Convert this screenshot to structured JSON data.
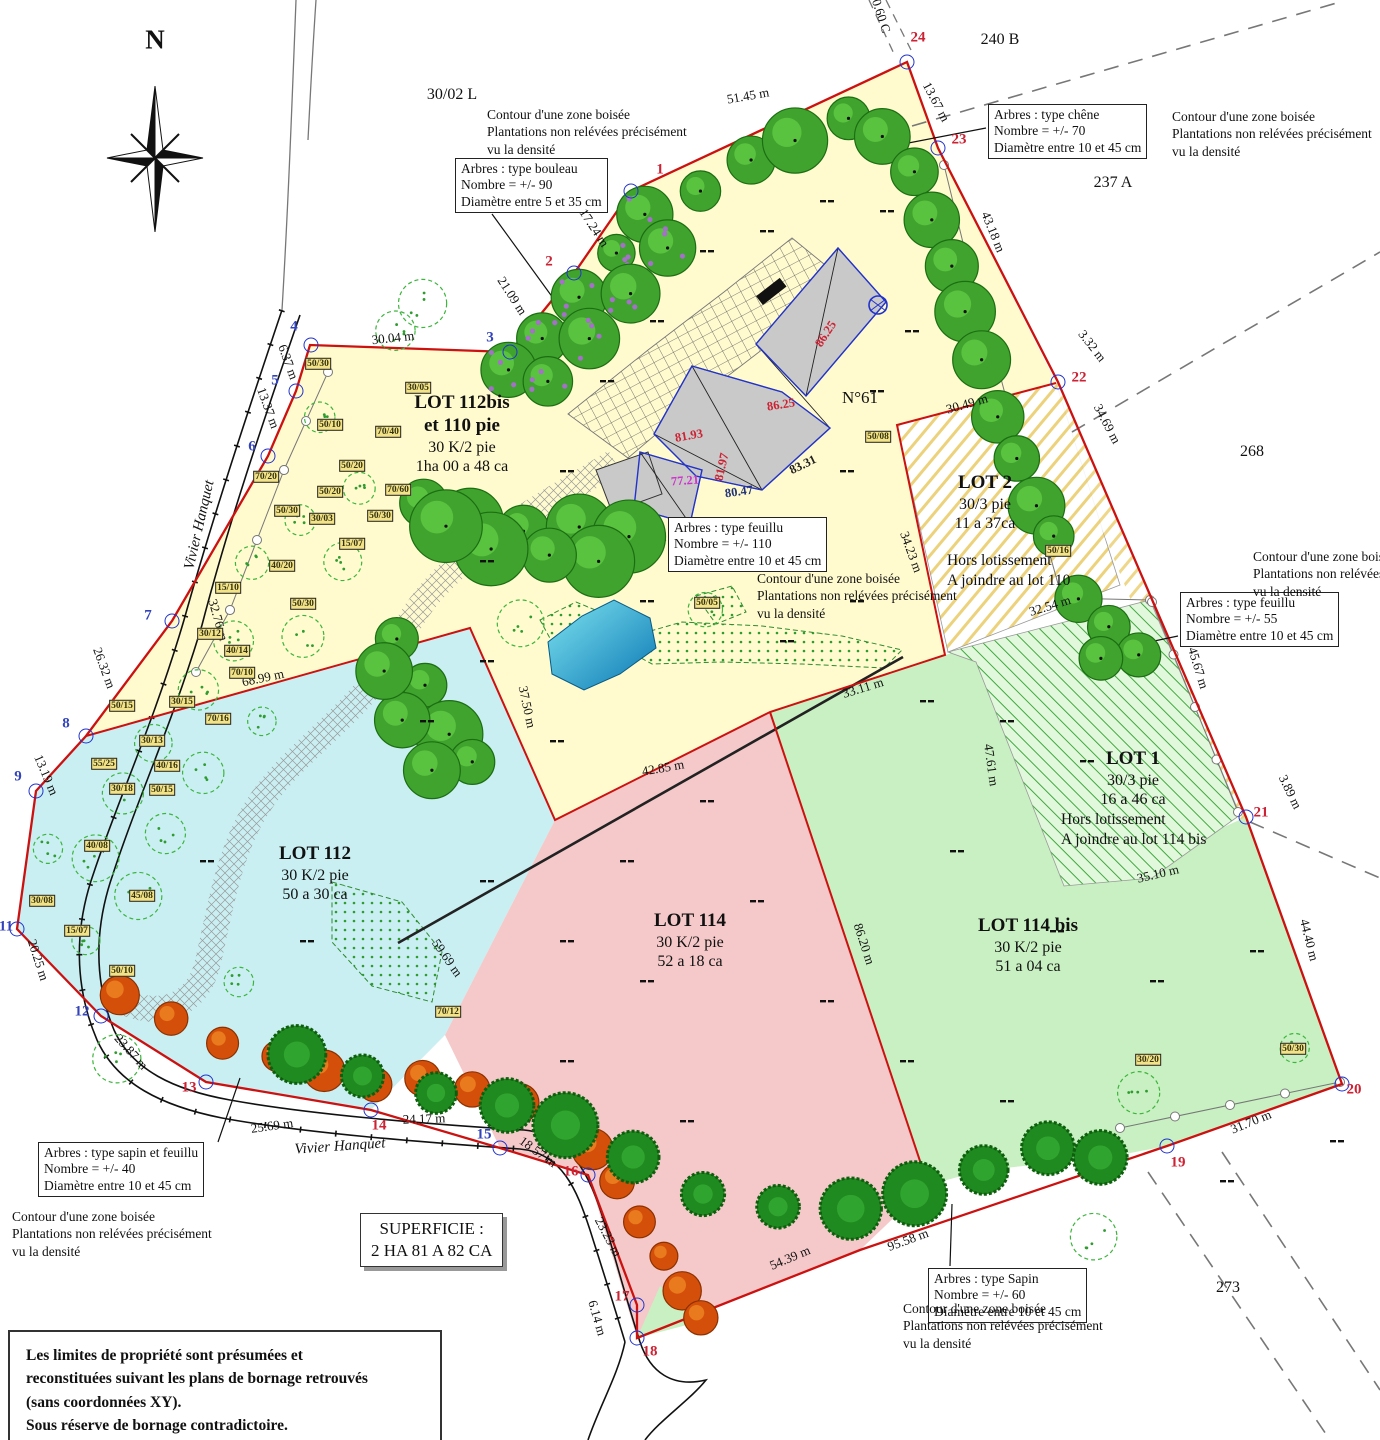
{
  "compass": {
    "label": "N"
  },
  "parcels": [
    {
      "t": "30/02 L",
      "x": 452,
      "y": 95
    },
    {
      "t": "240 B",
      "x": 1000,
      "y": 40
    },
    {
      "t": "237 A",
      "x": 1113,
      "y": 183
    },
    {
      "t": "268",
      "x": 1252,
      "y": 452
    },
    {
      "t": "273",
      "x": 1228,
      "y": 1288
    }
  ],
  "streets": [
    {
      "t": "Vivier Hanquet",
      "x": 200,
      "y": 525,
      "r": -77
    },
    {
      "t": "Vivier Hanquet",
      "x": 340,
      "y": 1147,
      "r": -4
    }
  ],
  "contour_note": [
    "Contour d'une zone boisée",
    "Plantations non relévées précisément",
    "vu la densité"
  ],
  "annotations": {
    "bouleau": [
      "Arbres : type bouleau",
      "Nombre = +/- 90",
      "Diamètre entre 5 et 35 cm"
    ],
    "chene": [
      "Arbres : type chêne",
      "Nombre = +/- 70",
      "Diamètre entre 10 et 45 cm"
    ],
    "feuillu110": [
      "Arbres : type feuillu",
      "Nombre = +/- 110",
      "Diamètre entre 10 et 45 cm"
    ],
    "feuillu55": [
      "Arbres : type feuillu",
      "Nombre = +/- 55",
      "Diamètre entre 10 et 45 cm"
    ],
    "sapin_feuillu": [
      "Arbres : type sapin et feuillu",
      "Nombre = +/- 40",
      "Diamètre entre 10 et 45 cm"
    ],
    "sapin": [
      "Arbres : type Sapin",
      "Nombre = +/- 60",
      "Diamètre entre 10 et 45 cm"
    ]
  },
  "lots": {
    "lot112bis": [
      "LOT 112bis",
      "et 110 pie",
      "30 K/2 pie",
      "1ha 00 a 48 ca"
    ],
    "lot2": [
      "LOT 2",
      "30/3 pie",
      "11 a 37ca"
    ],
    "lot2_note": [
      "Hors lotissement",
      "A joindre au lot 110"
    ],
    "lot1": [
      "LOT 1",
      "30/3 pie",
      "16 a 46 ca"
    ],
    "lot1_note": [
      "Hors lotissement",
      "A joindre au lot 114 bis"
    ],
    "lot112": [
      "LOT 112",
      "30 K/2 pie",
      "50 a 30 ca"
    ],
    "lot114": [
      "LOT 114",
      "30 K/2 pie",
      "52 a 18 ca"
    ],
    "lot114bis": [
      "LOT 114 bis",
      "30 K/2 pie",
      "51 a 04 ca"
    ]
  },
  "building": {
    "number": "N°61"
  },
  "superficie": [
    "SUPERFICIE :",
    "2 HA 81 A 82 CA"
  ],
  "legal": [
    "Les limites de propriété sont présumées et",
    "reconstituées suivant les plans de bornage retrouvés",
    "(sans coordonnées XY).",
    "Sous réserve de bornage contradictoire."
  ],
  "measurements": [
    {
      "t": "51.45 m",
      "x": 748,
      "y": 96,
      "r": -10
    },
    {
      "t": "13.67 m",
      "x": 936,
      "y": 102,
      "r": 62
    },
    {
      "t": "43.18 m",
      "x": 993,
      "y": 232,
      "r": 68
    },
    {
      "t": "3.32 m",
      "x": 1092,
      "y": 346,
      "r": 52
    },
    {
      "t": "34.69 m",
      "x": 1107,
      "y": 424,
      "r": 62
    },
    {
      "t": "30.49 m",
      "x": 967,
      "y": 404,
      "r": -16
    },
    {
      "t": "32.54 m",
      "x": 1050,
      "y": 606,
      "r": -17
    },
    {
      "t": "45.67 m",
      "x": 1198,
      "y": 668,
      "r": 73
    },
    {
      "t": "3.89 m",
      "x": 1290,
      "y": 792,
      "r": 64
    },
    {
      "t": "35.10 m",
      "x": 1158,
      "y": 874,
      "r": -13
    },
    {
      "t": "44.40 m",
      "x": 1309,
      "y": 940,
      "r": 76
    },
    {
      "t": "31.70 m",
      "x": 1251,
      "y": 1122,
      "r": -22
    },
    {
      "t": "95.58 m",
      "x": 908,
      "y": 1240,
      "r": -20
    },
    {
      "t": "54.39 m",
      "x": 790,
      "y": 1258,
      "r": -23
    },
    {
      "t": "23.23 m",
      "x": 608,
      "y": 1237,
      "r": 62
    },
    {
      "t": "6.14 m",
      "x": 597,
      "y": 1318,
      "r": 74
    },
    {
      "t": "18.57 m",
      "x": 538,
      "y": 1152,
      "r": 36
    },
    {
      "t": "24.17 m",
      "x": 424,
      "y": 1119,
      "r": -2
    },
    {
      "t": "25.69 m",
      "x": 272,
      "y": 1126,
      "r": -8
    },
    {
      "t": "23.87 m",
      "x": 131,
      "y": 1052,
      "r": 48
    },
    {
      "t": "20.25 m",
      "x": 38,
      "y": 960,
      "r": 72
    },
    {
      "t": "13.19 m",
      "x": 46,
      "y": 775,
      "r": 67
    },
    {
      "t": "26.32 m",
      "x": 104,
      "y": 668,
      "r": 70
    },
    {
      "t": "32.76 m",
      "x": 218,
      "y": 620,
      "r": 74
    },
    {
      "t": "13.37 m",
      "x": 268,
      "y": 408,
      "r": 70
    },
    {
      "t": "6.37 m",
      "x": 288,
      "y": 362,
      "r": 70
    },
    {
      "t": "30.04 m",
      "x": 393,
      "y": 338,
      "r": -6
    },
    {
      "t": "21.09 m",
      "x": 512,
      "y": 296,
      "r": 57
    },
    {
      "t": "17.24 m",
      "x": 594,
      "y": 228,
      "r": 57
    },
    {
      "t": "68.99 m",
      "x": 263,
      "y": 678,
      "r": -12
    },
    {
      "t": "37.50 m",
      "x": 527,
      "y": 707,
      "r": 78
    },
    {
      "t": "42.85 m",
      "x": 663,
      "y": 768,
      "r": -10
    },
    {
      "t": "33.11 m",
      "x": 863,
      "y": 688,
      "r": -17
    },
    {
      "t": "34.23 m",
      "x": 911,
      "y": 552,
      "r": 70
    },
    {
      "t": "47.61 m",
      "x": 991,
      "y": 765,
      "r": 82
    },
    {
      "t": "86.20 m",
      "x": 864,
      "y": 944,
      "r": 72
    },
    {
      "t": "59.69 m",
      "x": 447,
      "y": 958,
      "r": 55
    },
    {
      "t": "0.60 C",
      "x": 881,
      "y": 16,
      "r": 72
    }
  ],
  "points": [
    {
      "n": "1",
      "c": "red",
      "x": 660,
      "y": 170,
      "cx": 631,
      "cy": 191
    },
    {
      "n": "2",
      "c": "red",
      "x": 549,
      "y": 262,
      "cx": 574,
      "cy": 273
    },
    {
      "n": "3",
      "c": "blue",
      "x": 490,
      "y": 338,
      "cx": 510,
      "cy": 352
    },
    {
      "n": "4",
      "c": "blue",
      "x": 294,
      "y": 327,
      "cx": 311,
      "cy": 345
    },
    {
      "n": "5",
      "c": "blue",
      "x": 275,
      "y": 381,
      "cx": 296,
      "cy": 391
    },
    {
      "n": "6",
      "c": "blue",
      "x": 252,
      "y": 447,
      "cx": 268,
      "cy": 456
    },
    {
      "n": "7",
      "c": "blue",
      "x": 148,
      "y": 616,
      "cx": 172,
      "cy": 621
    },
    {
      "n": "8",
      "c": "blue",
      "x": 66,
      "y": 724,
      "cx": 86,
      "cy": 736
    },
    {
      "n": "9",
      "c": "blue",
      "x": 18,
      "y": 777,
      "cx": 36,
      "cy": 791
    },
    {
      "n": "11",
      "c": "blue",
      "x": 6,
      "y": 927,
      "cx": 17,
      "cy": 929
    },
    {
      "n": "12",
      "c": "blue",
      "x": 82,
      "y": 1012,
      "cx": 101,
      "cy": 1016
    },
    {
      "n": "13",
      "c": "red",
      "x": 189,
      "y": 1088,
      "cx": 206,
      "cy": 1082
    },
    {
      "n": "14",
      "c": "red",
      "x": 379,
      "y": 1126,
      "cx": 371,
      "cy": 1110
    },
    {
      "n": "15",
      "c": "blue",
      "x": 484,
      "y": 1135,
      "cx": 500,
      "cy": 1148
    },
    {
      "n": "16",
      "c": "red",
      "x": 571,
      "y": 1172,
      "cx": 588,
      "cy": 1175
    },
    {
      "n": "17",
      "c": "red",
      "x": 622,
      "y": 1297,
      "cx": 637,
      "cy": 1305
    },
    {
      "n": "18",
      "c": "red",
      "x": 650,
      "y": 1352,
      "cx": 637,
      "cy": 1338
    },
    {
      "n": "19",
      "c": "red",
      "x": 1178,
      "y": 1163,
      "cx": 1167,
      "cy": 1146
    },
    {
      "n": "20",
      "c": "red",
      "x": 1354,
      "y": 1090,
      "cx": 1342,
      "cy": 1084
    },
    {
      "n": "21",
      "c": "red",
      "x": 1261,
      "y": 813,
      "cx": 1246,
      "cy": 817
    },
    {
      "n": "22",
      "c": "red",
      "x": 1079,
      "y": 378,
      "cx": 1058,
      "cy": 382
    },
    {
      "n": "23",
      "c": "red",
      "x": 959,
      "y": 140,
      "cx": 938,
      "cy": 148
    },
    {
      "n": "24",
      "c": "red",
      "x": 918,
      "y": 38,
      "cx": 907,
      "cy": 62
    }
  ],
  "elevations": [
    {
      "t": "86.25",
      "x": 826,
      "y": 334,
      "r": -57,
      "c": "#CC2233"
    },
    {
      "t": "86.25",
      "x": 781,
      "y": 405,
      "r": -9,
      "c": "#CC2233"
    },
    {
      "t": "81.93",
      "x": 689,
      "y": 436,
      "r": -10,
      "c": "#CC2233"
    },
    {
      "t": "81.97",
      "x": 722,
      "y": 467,
      "r": -77,
      "c": "#CC2233"
    },
    {
      "t": "77.21",
      "x": 685,
      "y": 481,
      "r": -4,
      "c": "#CC33CC"
    },
    {
      "t": "80.47",
      "x": 739,
      "y": 492,
      "r": -8,
      "c": "#223377"
    },
    {
      "t": "83.31",
      "x": 803,
      "y": 465,
      "r": -26,
      "c": "#222222"
    }
  ],
  "tree_tags": [
    {
      "t": "50/30",
      "x": 318,
      "y": 364
    },
    {
      "t": "30/05",
      "x": 418,
      "y": 388
    },
    {
      "t": "70/40",
      "x": 388,
      "y": 432
    },
    {
      "t": "50/10",
      "x": 330,
      "y": 425
    },
    {
      "t": "70/20",
      "x": 266,
      "y": 477
    },
    {
      "t": "50/20",
      "x": 352,
      "y": 466
    },
    {
      "t": "50/20",
      "x": 330,
      "y": 492
    },
    {
      "t": "70/60",
      "x": 398,
      "y": 490
    },
    {
      "t": "50/30",
      "x": 287,
      "y": 511
    },
    {
      "t": "30/03",
      "x": 322,
      "y": 519
    },
    {
      "t": "50/30",
      "x": 380,
      "y": 516
    },
    {
      "t": "15/07",
      "x": 352,
      "y": 544
    },
    {
      "t": "40/20",
      "x": 282,
      "y": 566
    },
    {
      "t": "15/10",
      "x": 228,
      "y": 588
    },
    {
      "t": "50/30",
      "x": 303,
      "y": 604
    },
    {
      "t": "30/12",
      "x": 210,
      "y": 634
    },
    {
      "t": "40/14",
      "x": 237,
      "y": 651
    },
    {
      "t": "70/10",
      "x": 242,
      "y": 673
    },
    {
      "t": "30/15",
      "x": 182,
      "y": 702
    },
    {
      "t": "50/15",
      "x": 122,
      "y": 706
    },
    {
      "t": "70/16",
      "x": 218,
      "y": 719
    },
    {
      "t": "30/13",
      "x": 152,
      "y": 741
    },
    {
      "t": "55/25",
      "x": 104,
      "y": 764
    },
    {
      "t": "40/16",
      "x": 167,
      "y": 766
    },
    {
      "t": "30/18",
      "x": 122,
      "y": 789
    },
    {
      "t": "50/15",
      "x": 162,
      "y": 790
    },
    {
      "t": "40/08",
      "x": 97,
      "y": 846
    },
    {
      "t": "30/08",
      "x": 42,
      "y": 901
    },
    {
      "t": "45/08",
      "x": 142,
      "y": 896
    },
    {
      "t": "15/07",
      "x": 77,
      "y": 931
    },
    {
      "t": "50/10",
      "x": 122,
      "y": 971
    },
    {
      "t": "70/12",
      "x": 448,
      "y": 1012
    },
    {
      "t": "50/16",
      "x": 1058,
      "y": 551
    },
    {
      "t": "50/05",
      "x": 707,
      "y": 603
    },
    {
      "t": "50/08",
      "x": 878,
      "y": 437
    },
    {
      "t": "50/30",
      "x": 1293,
      "y": 1049
    },
    {
      "t": "30/20",
      "x": 1148,
      "y": 1060
    }
  ],
  "colors": {
    "boundary_red": "#CC1111",
    "point_circle_blue": "#2233CC",
    "point_label_red": "#CC2233",
    "point_label_blue": "#3344BB",
    "main_fill": "#FFFBCF",
    "lot112_fill": "#C9EFF2",
    "lot114_fill": "#F5C9C9",
    "lot114bis_fill": "#C9F0C2"
  },
  "vegetation_bands": [
    {
      "type": "bouleau",
      "r": 24,
      "pts": [
        [
          648,
          212
        ],
        [
          614,
          252
        ],
        [
          578,
          295
        ],
        [
          540,
          338
        ],
        [
          508,
          366
        ],
        [
          544,
          378
        ],
        [
          586,
          336
        ],
        [
          628,
          290
        ],
        [
          664,
          246
        ]
      ]
    },
    {
      "type": "feuillu",
      "r": 27,
      "pts": [
        [
          702,
          188
        ],
        [
          748,
          163
        ],
        [
          798,
          140
        ],
        [
          848,
          120
        ],
        [
          884,
          136
        ],
        [
          914,
          172
        ],
        [
          932,
          218
        ],
        [
          950,
          265
        ],
        [
          964,
          312
        ],
        [
          982,
          362
        ],
        [
          1000,
          416
        ],
        [
          1016,
          462
        ],
        [
          1040,
          506
        ],
        [
          1054,
          540
        ]
      ]
    },
    {
      "type": "feuillu",
      "r": 30,
      "pts": [
        [
          422,
          505
        ],
        [
          472,
          520
        ],
        [
          522,
          528
        ],
        [
          576,
          524
        ],
        [
          626,
          538
        ],
        [
          600,
          558
        ],
        [
          546,
          552
        ],
        [
          488,
          545
        ],
        [
          442,
          530
        ]
      ]
    },
    {
      "type": "feuillu",
      "r": 28,
      "pts": [
        [
          400,
          636
        ],
        [
          422,
          688
        ],
        [
          452,
          734
        ],
        [
          472,
          762
        ],
        [
          432,
          770
        ],
        [
          402,
          722
        ],
        [
          386,
          672
        ]
      ]
    },
    {
      "type": "feuillu",
      "r": 24,
      "pts": [
        [
          1080,
          600
        ],
        [
          1110,
          628
        ],
        [
          1140,
          656
        ],
        [
          1102,
          662
        ]
      ]
    },
    {
      "type": "autumn",
      "r": 17,
      "pts": [
        [
          120,
          996
        ],
        [
          172,
          1020
        ],
        [
          224,
          1040
        ],
        [
          274,
          1056
        ],
        [
          324,
          1070
        ],
        [
          374,
          1084
        ],
        [
          422,
          1076
        ],
        [
          470,
          1086
        ],
        [
          516,
          1100
        ],
        [
          558,
          1120
        ],
        [
          592,
          1150
        ],
        [
          618,
          1184
        ],
        [
          642,
          1220
        ],
        [
          662,
          1256
        ],
        [
          682,
          1290
        ],
        [
          700,
          1316
        ]
      ]
    },
    {
      "type": "conifer",
      "r": 27,
      "pts": [
        [
          300,
          1058
        ],
        [
          366,
          1076
        ],
        [
          436,
          1090
        ],
        [
          504,
          1106
        ],
        [
          566,
          1128
        ],
        [
          636,
          1160
        ],
        [
          706,
          1192
        ],
        [
          776,
          1204
        ],
        [
          848,
          1210
        ],
        [
          916,
          1194
        ],
        [
          984,
          1170
        ],
        [
          1048,
          1152
        ],
        [
          1104,
          1158
        ]
      ]
    },
    {
      "type": "shrub",
      "r": 19,
      "pts": [
        [
          322,
          420
        ],
        [
          362,
          490
        ],
        [
          302,
          520
        ],
        [
          252,
          562
        ],
        [
          342,
          560
        ],
        [
          232,
          640
        ],
        [
          302,
          640
        ],
        [
          202,
          690
        ],
        [
          262,
          720
        ],
        [
          152,
          742
        ],
        [
          202,
          772
        ],
        [
          122,
          790
        ],
        [
          162,
          830
        ],
        [
          92,
          862
        ],
        [
          142,
          892
        ],
        [
          82,
          940
        ],
        [
          422,
          300
        ],
        [
          392,
          332
        ],
        [
          522,
          620
        ],
        [
          702,
          608
        ],
        [
          1092,
          1240
        ],
        [
          1142,
          1096
        ],
        [
          1298,
          1044
        ],
        [
          44,
          852
        ],
        [
          120,
          1060
        ],
        [
          240,
          980
        ]
      ]
    }
  ]
}
